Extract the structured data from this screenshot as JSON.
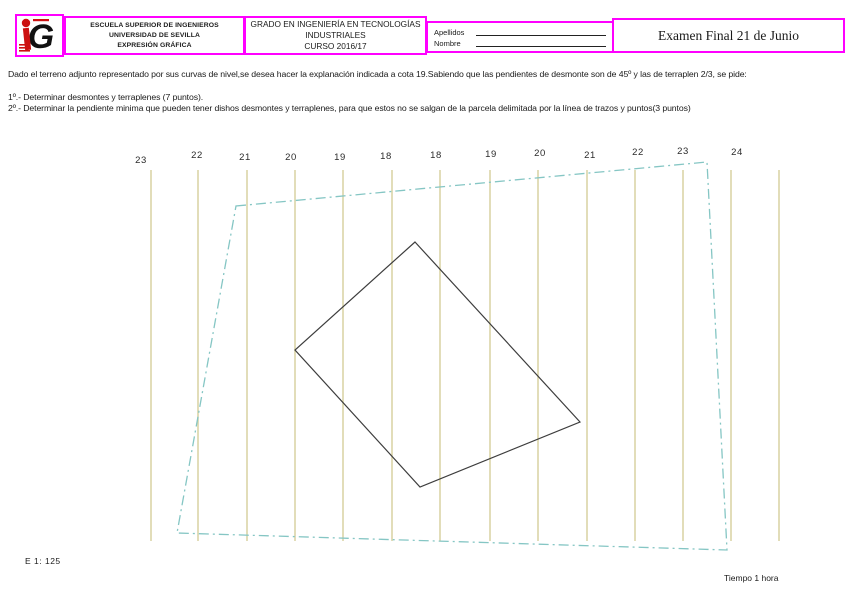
{
  "header": {
    "school": {
      "line1": "ESCUELA SUPERIOR DE INGENIEROS",
      "line2": "UNIVERSIDAD DE SEVILLA",
      "line3": "EXPRESIÓN GRÁFICA"
    },
    "degree": {
      "line1": "GRADO EN INGENIERÍA EN TECNOLOGÍAS",
      "line2": "INDUSTRIALES",
      "line3": "CURSO 2016/17"
    },
    "name_fields": {
      "apellidos_label": "Apellidos",
      "nombre_label": "Nombre"
    },
    "exam_title": "Examen Final  21 de Junio"
  },
  "statement": {
    "intro": "Dado el terreno adjunto representado por sus curvas de nivel,se desea hacer la explanación indicada a cota 19.Sabiendo que las pendientes de desmonte son de 45º y las de terraplen 2/3, se pide:",
    "item1": "1º.- Determinar desmontes y terraplenes (7 puntos).",
    "item2": "2º.- Determinar la pendiente minima que pueden tener dishos desmontes y terraplenes, para que estos no se salgan de la parcela delimitada por la línea de trazos y puntos(3 puntos)"
  },
  "drawing": {
    "top_y": 170,
    "bottom_y": 541,
    "contours": [
      {
        "label": "23",
        "x": 151,
        "label_x": 141,
        "label_y": 163
      },
      {
        "label": "22",
        "x": 198,
        "label_x": 197,
        "label_y": 158
      },
      {
        "label": "21",
        "x": 247,
        "label_x": 245,
        "label_y": 160
      },
      {
        "label": "20",
        "x": 295,
        "label_x": 291,
        "label_y": 160
      },
      {
        "label": "19",
        "x": 343,
        "label_x": 340,
        "label_y": 160
      },
      {
        "label": "18",
        "x": 392,
        "label_x": 386,
        "label_y": 159
      },
      {
        "label": "18",
        "x": 440,
        "label_x": 436,
        "label_y": 158
      },
      {
        "label": "19",
        "x": 490,
        "label_x": 491,
        "label_y": 157
      },
      {
        "label": "20",
        "x": 538,
        "label_x": 540,
        "label_y": 156
      },
      {
        "label": "21",
        "x": 587,
        "label_x": 590,
        "label_y": 158
      },
      {
        "label": "22",
        "x": 635,
        "label_x": 638,
        "label_y": 155
      },
      {
        "label": "23",
        "x": 683,
        "label_x": 683,
        "label_y": 154
      },
      {
        "label": "24",
        "x": 731,
        "label_x": 737,
        "label_y": 155
      },
      {
        "label": "",
        "x": 779,
        "label_x": 779,
        "label_y": 155
      }
    ],
    "parcel_polygon": [
      [
        236,
        206
      ],
      [
        707,
        162
      ],
      [
        727,
        550
      ],
      [
        177,
        533
      ]
    ],
    "platform_polygon": [
      [
        415,
        242
      ],
      [
        580,
        422
      ],
      [
        420,
        487
      ],
      [
        295,
        350
      ]
    ],
    "colors": {
      "contour_line": "#d8d2a2",
      "parcel_line": "#85c6c4",
      "platform_line": "#3d3d3d",
      "frame_border": "#ff00ff",
      "logo_red": "#cc1111"
    }
  },
  "footer": {
    "scale": "E  1: 125",
    "time": "Tiempo 1 hora"
  }
}
